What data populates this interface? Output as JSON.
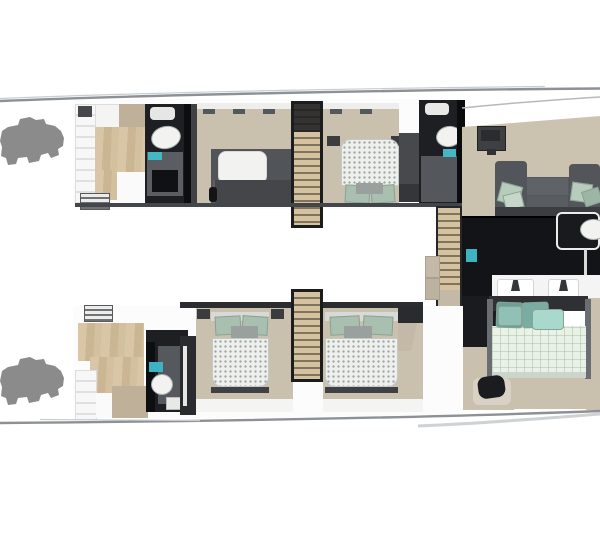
{
  "meta": {
    "title": "Catamaran yacht lower-deck floor plan (top-down 3D render)",
    "view": "plan view, bow to the right, image cropped at right edge",
    "background": "#ffffff"
  },
  "palette": {
    "hull_white": "#fcfcfc",
    "rail_gray": "#8d9196",
    "floor_beige": "#c9c0ae",
    "tan_patch": "#bfb09a",
    "wood": "#cfbd9d",
    "bathroom_black": "#1e1f23",
    "bathroom_floor_gray": "#55585c",
    "galley_black": "#131418",
    "sofa_gray": "#55585c",
    "pillow_green": "#a9c0b0",
    "pillow_teal": "#79ada4",
    "pillow_aqua": "#a9d8cd",
    "duvet_mint": "#eaf2e7",
    "teal_accent": "#3cb3c1",
    "tender_gray": "#8b8b8b"
  },
  "vessel": {
    "hulls": [
      {
        "id": "port-hull",
        "label": "Port hull (top)",
        "rooms": [
          {
            "label": "Aft transom steps"
          },
          {
            "label": "Aft crew cabin with wood sole"
          },
          {
            "label": "Aft bathroom with oval washbasin"
          },
          {
            "label": "Guest cabin with berth and settee"
          },
          {
            "label": "Companionway staircase"
          },
          {
            "label": "VIP cabin with double bed, green pillows"
          },
          {
            "label": "Forward bathroom with oval washbasin"
          }
        ]
      },
      {
        "id": "starboard-hull",
        "label": "Starboard hull (bottom)",
        "rooms": [
          {
            "label": "Aft transom steps"
          },
          {
            "label": "Aft crew cabin with wood sole and berth"
          },
          {
            "label": "Aft bathroom with toilet and teal basin"
          },
          {
            "label": "Guest double cabin, quilted mattress"
          },
          {
            "label": "Companionway staircase"
          },
          {
            "label": "Guest double cabin, quilted mattress"
          }
        ]
      }
    ],
    "bridge_deck": {
      "label": "Main deck / forward suite (right, cropped)",
      "rooms": [
        {
          "label": "Salon lounge with U-sofa and green cushions"
        },
        {
          "label": "Dining table with oval top"
        },
        {
          "label": "Dark galley sole"
        },
        {
          "label": "Stair column with wood treads and side tables"
        },
        {
          "label": "Twin-sink vanity counter"
        },
        {
          "label": "Master bed with teal pillows and mint quilt"
        },
        {
          "label": "Master bathroom with toilet and teal basin"
        }
      ]
    },
    "tenders": [
      {
        "label": "Jet-ski silhouette, port aft"
      },
      {
        "label": "Jet-ski silhouette, starboard aft"
      }
    ]
  }
}
